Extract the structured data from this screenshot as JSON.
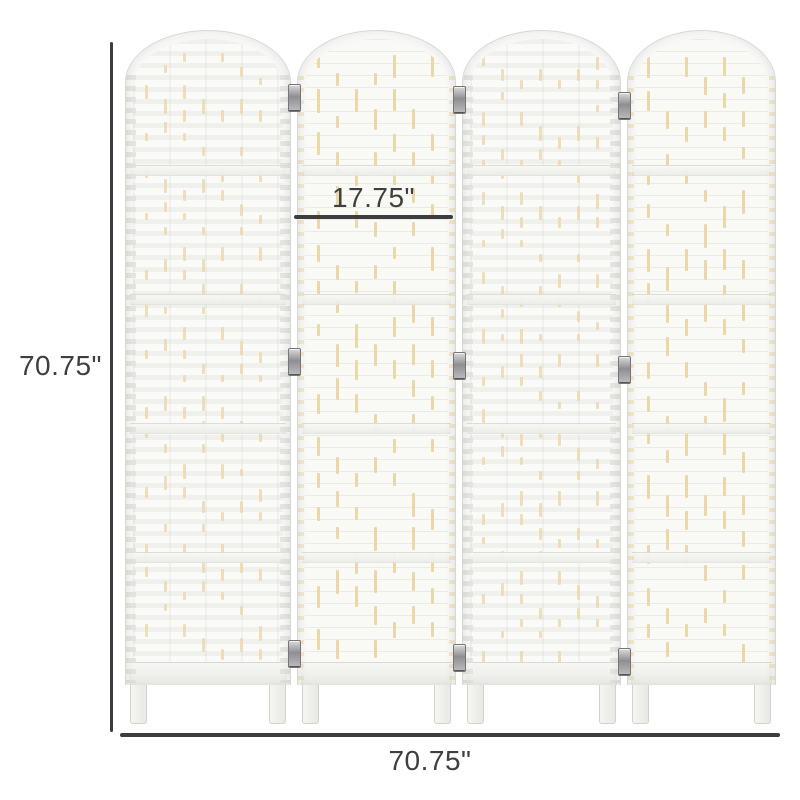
{
  "product": {
    "panel_count": 4,
    "sections_per_panel": 5,
    "hinge_rows": 3
  },
  "dimensions": {
    "height_label": "70.75\"",
    "width_label": "70.75\"",
    "panel_width_label": "17.75\""
  },
  "colors": {
    "background": "#ffffff",
    "dimension_line": "#3d3d3d",
    "label_text": "#3f3f3f",
    "panel_base": "#f8f8f6",
    "frame_border": "#d8d8d3",
    "weave_accent": "#ecd7a9",
    "hinge_metal": "#8f8f93"
  }
}
